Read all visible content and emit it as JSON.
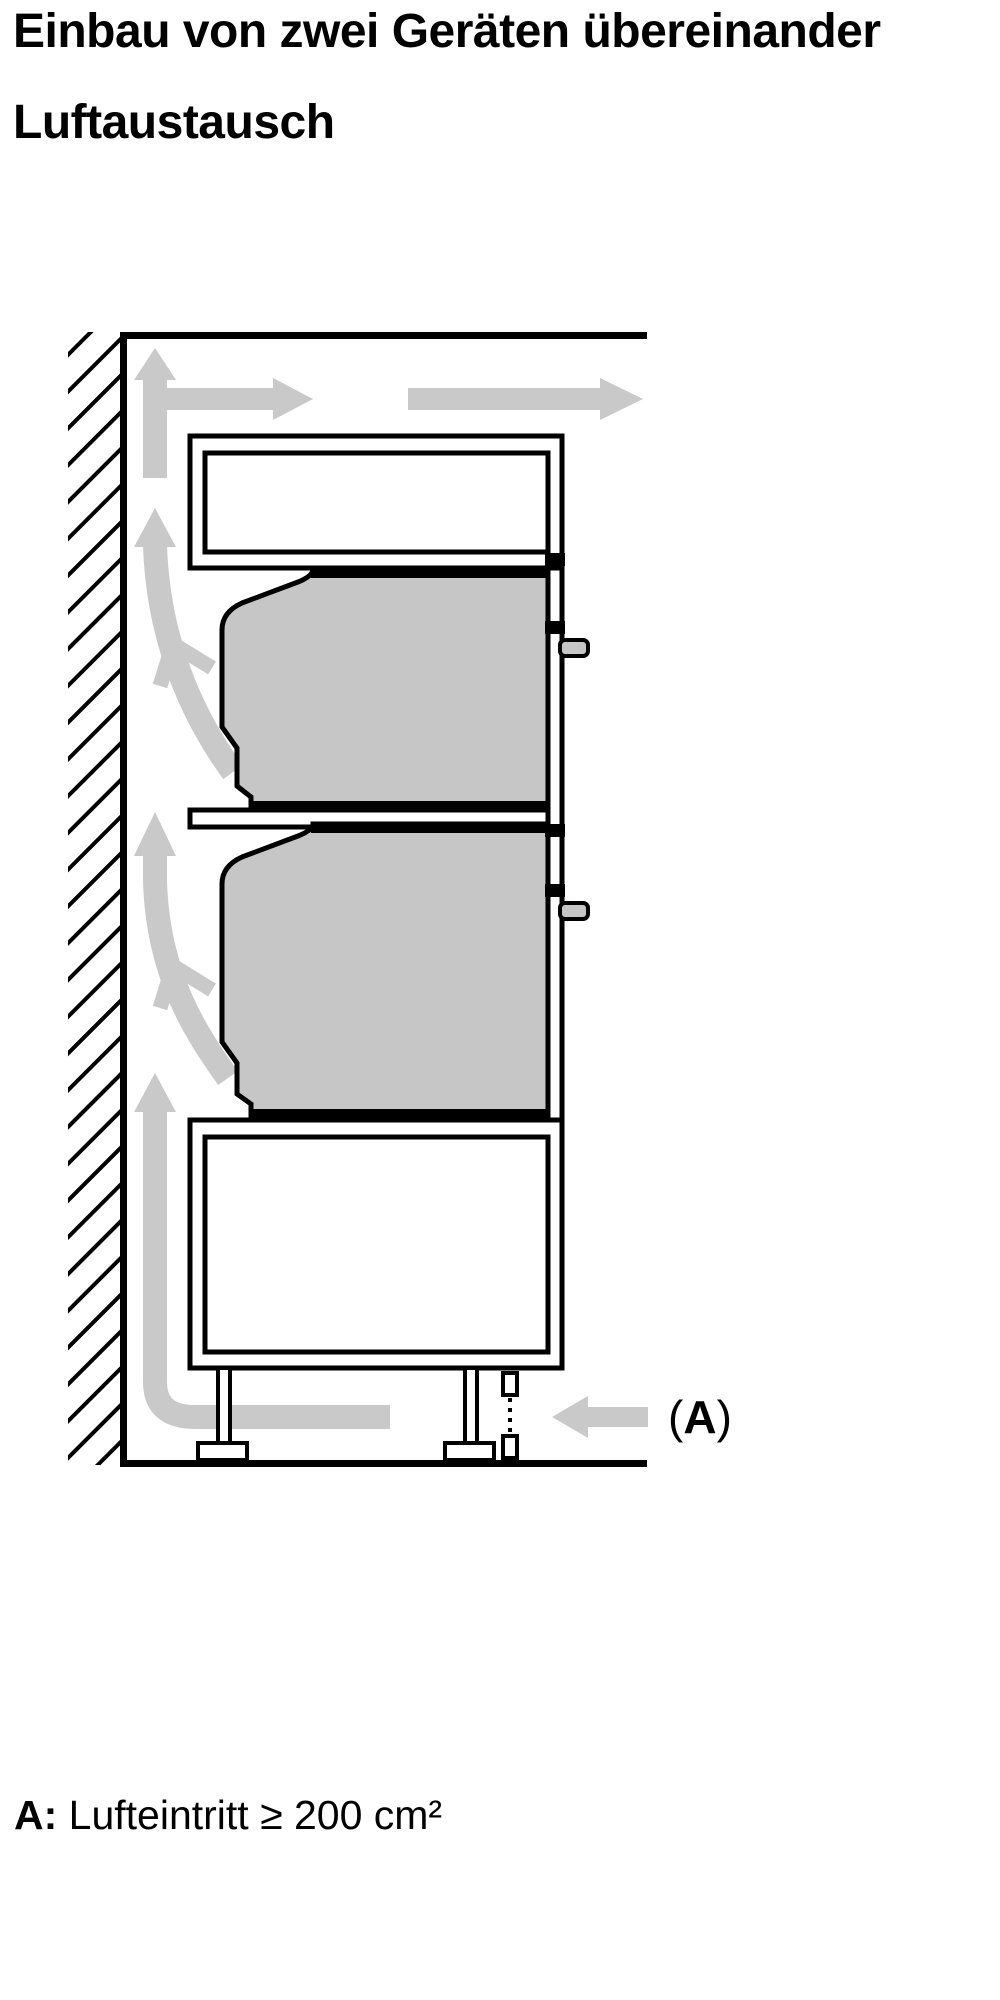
{
  "titles": {
    "heading": "Einbau von zwei Geräten übereinander",
    "subheading": "Luftaustausch"
  },
  "diagram_label": {
    "open": "(",
    "letter": "A",
    "close": ")"
  },
  "caption": {
    "term": "A:",
    "definition": " Lufteintritt ≥ 200 cm²"
  },
  "colors": {
    "ink": "#000000",
    "appliance_gray": "#c6c6c6",
    "airflow_gray": "#c9c9c9",
    "paper": "#ffffff"
  }
}
